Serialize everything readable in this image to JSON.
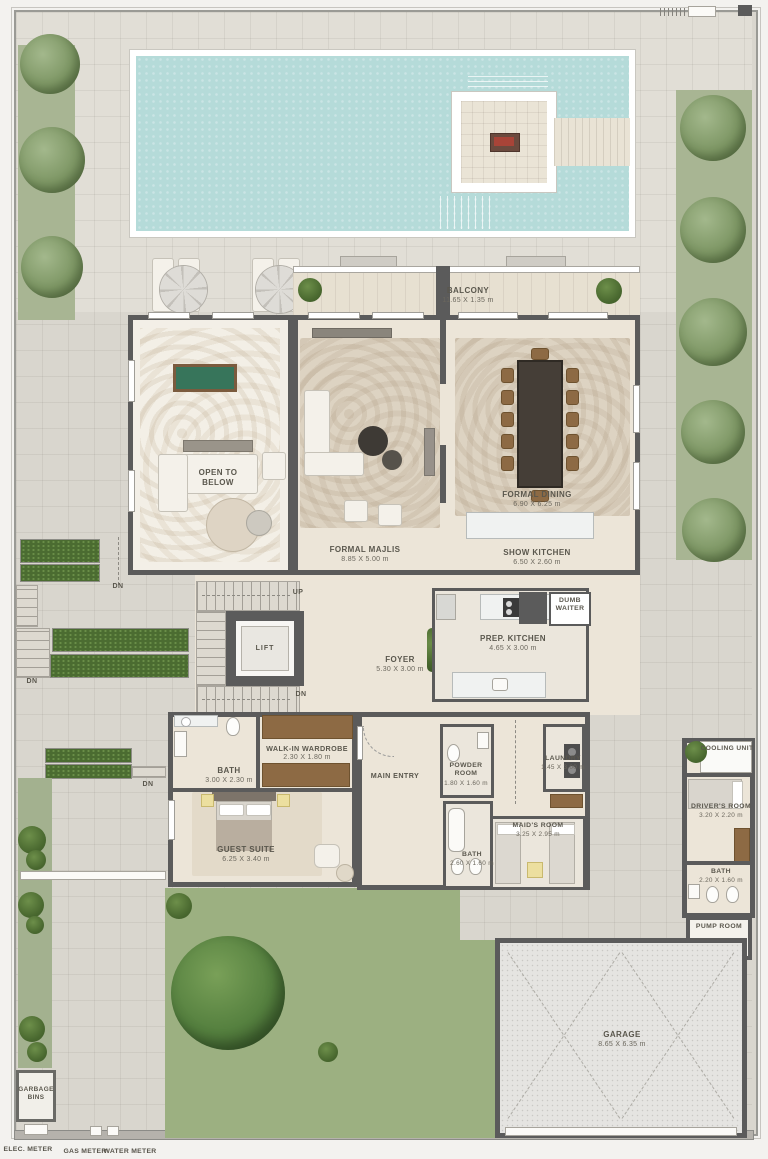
{
  "colors": {
    "pool_water": "#b5dbd9",
    "paving": "#d9d6ce",
    "interior_floor": "#ece5d8",
    "wall": "#5b5b5b",
    "lawn": "#a8b593",
    "lawn_bottom": "#9cb081",
    "hedge": "#4b6c31",
    "wood": "#8d6a44"
  },
  "rooms": {
    "balcony": {
      "name": "BALCONY",
      "dim": "11.65 X 1.35 m"
    },
    "open_to_below": {
      "name": "OPEN TO BELOW"
    },
    "formal_majlis": {
      "name": "FORMAL MAJLIS",
      "dim": "8.85 X 5.00 m"
    },
    "formal_dining": {
      "name": "FORMAL DINING",
      "dim": "6.90 X 6.25 m"
    },
    "show_kitchen": {
      "name": "SHOW KITCHEN",
      "dim": "6.50 X 2.60 m"
    },
    "dumb_waiter": {
      "name": "DUMB WAITER"
    },
    "prep_kitchen": {
      "name": "PREP. KITCHEN",
      "dim": "4.65 X 3.00 m"
    },
    "foyer": {
      "name": "FOYER",
      "dim": "5.30 X 3.00 m"
    },
    "lift": {
      "name": "LIFT"
    },
    "walk_in_wardrobe": {
      "name": "WALK-IN WARDROBE",
      "dim": "2.30 X 1.80 m"
    },
    "guest_bath": {
      "name": "BATH",
      "dim": "3.00 X 2.30 m"
    },
    "guest_suite": {
      "name": "GUEST SUITE",
      "dim": "6.25 X 3.40 m"
    },
    "main_entry": {
      "name": "MAIN ENTRY"
    },
    "powder_room": {
      "name": "POWDER ROOM",
      "dim": "1.80 X 1.60 m"
    },
    "laundry": {
      "name": "LAUNDRY",
      "dim": "1.45 X 3.00 m"
    },
    "maids_room": {
      "name": "MAID'S ROOM",
      "dim": "3.25 X 2.95 m"
    },
    "maids_bath": {
      "name": "BATH",
      "dim": "2.60 X 1.60 m"
    },
    "cooling_unit": {
      "name": "COOLING UNIT"
    },
    "drivers_room": {
      "name": "DRIVER'S ROOM",
      "dim": "3.20 X 2.20 m"
    },
    "drivers_bath": {
      "name": "BATH",
      "dim": "2.20 X 1.60 m"
    },
    "pump_room": {
      "name": "PUMP ROOM"
    },
    "garage": {
      "name": "GARAGE",
      "dim": "8.65 X 6.35 m"
    },
    "garbage_bins": {
      "name": "GARBAGE BINS"
    }
  },
  "stairs": {
    "up": "UP",
    "down": "DN"
  },
  "site_labels": {
    "elec_meter": "ELEC. METER",
    "gas_meter": "GAS METER",
    "water_meter": "WATER METER"
  }
}
